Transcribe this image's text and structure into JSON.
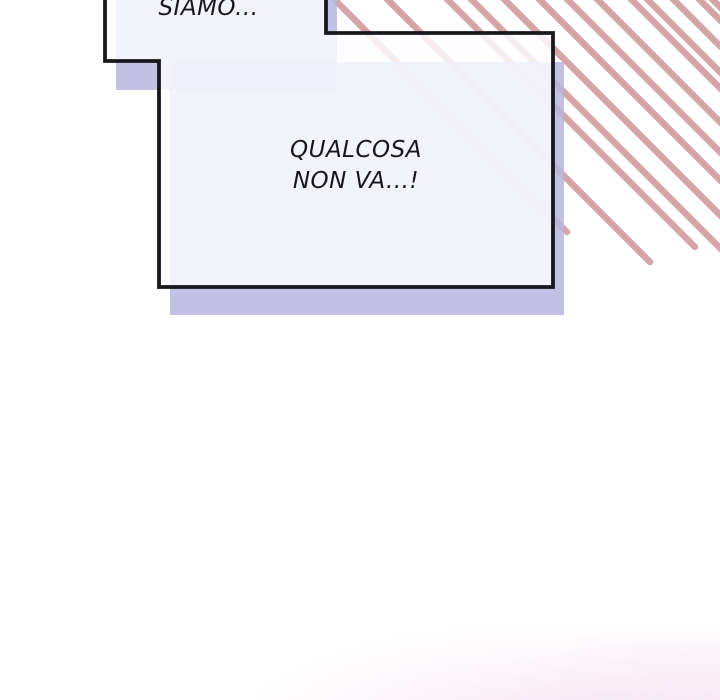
{
  "comic": {
    "speech_bubbles": [
      {
        "name": "top-bubble",
        "text": "SIAMO..."
      },
      {
        "name": "main-bubble",
        "line1": "QUALCOSA",
        "line2": "NON VA...!"
      }
    ],
    "colors": {
      "speed_line": "#d5a4a7",
      "bubble_shadow": "rgba(183,182,223,0.85)",
      "bubble_fill": "rgba(252,252,255,0.82)",
      "bubble_outline": "#18171b",
      "text": "#17161a",
      "background": "#ffffff",
      "blush": "#f4dcee"
    }
  }
}
